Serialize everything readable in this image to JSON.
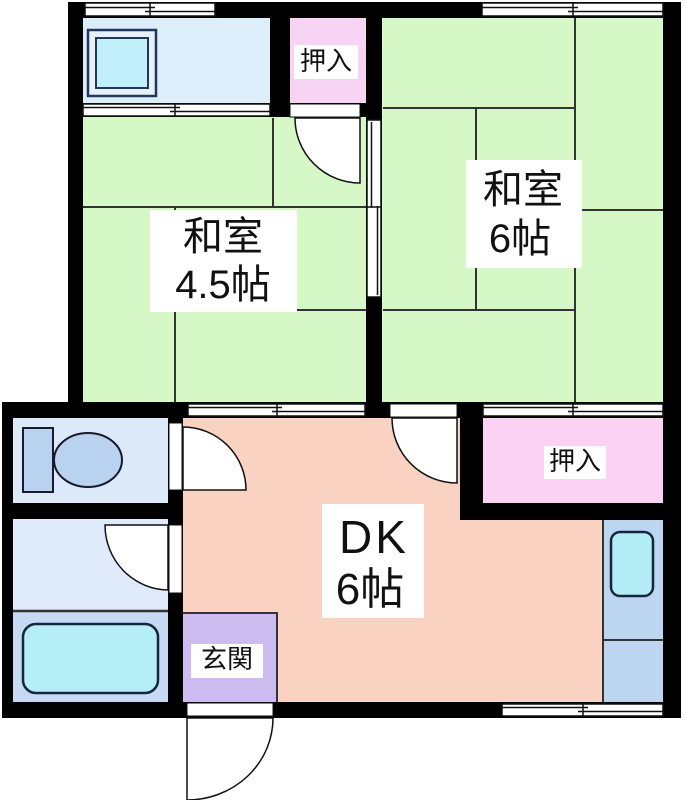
{
  "floorplan": {
    "rooms": {
      "washitsu_45": {
        "name_line1": "和室",
        "name_line2": "4.5帖",
        "color": "#d5f8c6"
      },
      "washitsu_6": {
        "name_line1": "和室",
        "name_line2": "6帖",
        "color": "#d5f8c6"
      },
      "dk": {
        "name_line1": "DK",
        "name_line2": "6帖",
        "color": "#f9d2c2"
      },
      "genkan": {
        "name": "玄関",
        "color": "#ccbcf0"
      },
      "closet_top": {
        "name": "押入",
        "color": "#f8d4f4"
      },
      "closet_right": {
        "name": "押入",
        "color": "#fbd2f4"
      },
      "toilet": {
        "color": "#dce9f8"
      },
      "washroom": {
        "color": "#dfebfa"
      },
      "bathroom": {
        "color": "#c6daf4"
      },
      "laundry": {
        "color": "#ddeefb"
      },
      "kitchen_counter": {
        "color": "#bcd6f2"
      }
    },
    "fixtures": {
      "bathtub_color": "#b6eef8",
      "kitchen_sink_color": "#b2ecf4",
      "washer_pan_color": "#c2f0fa",
      "toilet_color": "#b9d2f0",
      "fixture_outline": "#16263e"
    },
    "colors": {
      "wall": "#000000",
      "tatami_line": "#333333"
    }
  }
}
